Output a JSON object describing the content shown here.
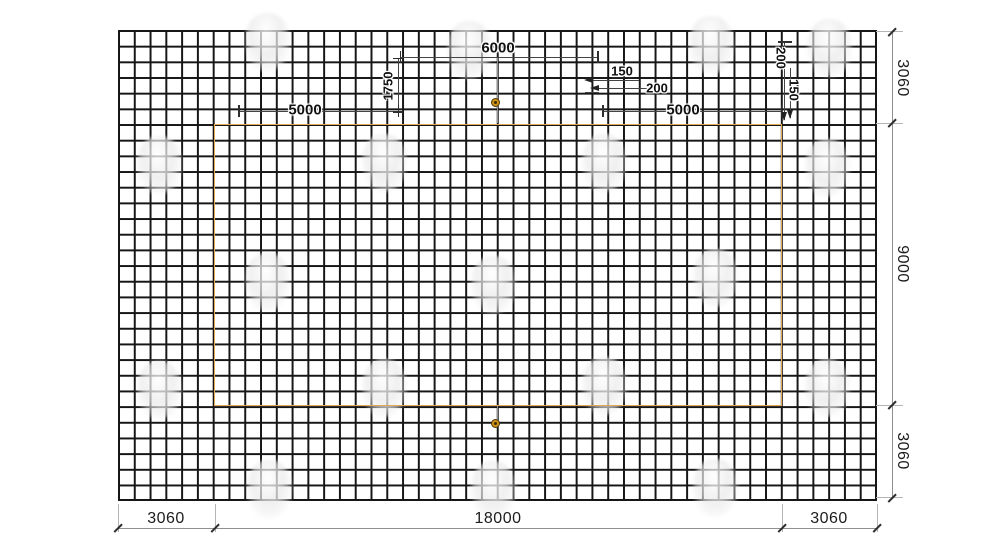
{
  "drawing": {
    "type": "mesh-reinforcement-plan",
    "colors": {
      "grid_line": "#161616",
      "inner_outline": "#e2a855",
      "dimension_line": "#8f8f8f",
      "marker_ring": "#cf9015"
    },
    "dims": {
      "bottom": [
        "3060",
        "18000",
        "3060"
      ],
      "right": [
        "3060",
        "9000",
        "3060"
      ],
      "top": {
        "span6000": "6000",
        "left5000": "5000",
        "right5000": "5000",
        "v1750": "1750"
      },
      "spacing": {
        "left_top": "150",
        "left_bottom": "200",
        "right_top": "200",
        "right_bottom": "150"
      }
    }
  }
}
